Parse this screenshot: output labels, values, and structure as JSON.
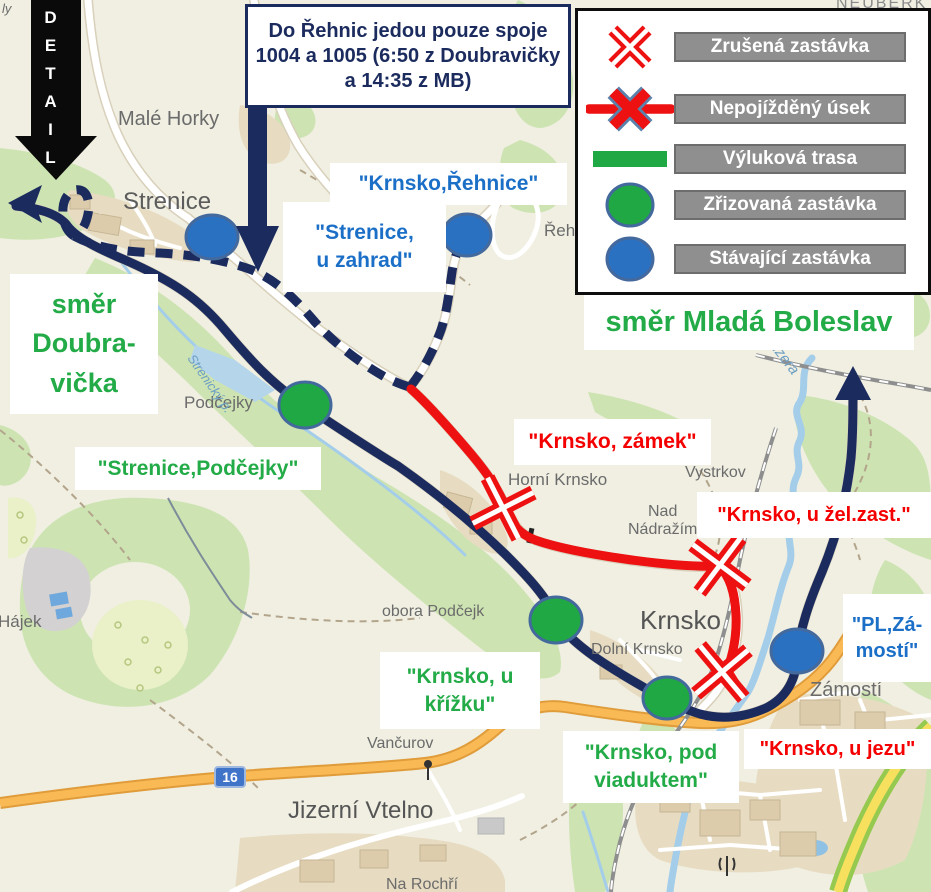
{
  "title": "Výluková mapa Krnsko",
  "info_box": {
    "text": "Do Řehnic jedou pouze spoje 1004 a 1005 (6:50 z Doubravičky a 14:35 z MB)"
  },
  "detail_arrow": {
    "label": "DETAIL"
  },
  "legend": {
    "items": [
      {
        "icon": "cancelled-stop-icon",
        "label": "Zrušená zastávka"
      },
      {
        "icon": "closed-section-icon",
        "label": "Nepojížděný úsek"
      },
      {
        "icon": "detour-route-icon",
        "label": "Výluková trasa"
      },
      {
        "icon": "new-stop-icon",
        "label": "Zřizovaná zastávka"
      },
      {
        "icon": "existing-stop-icon",
        "label": "Stávající zastávka"
      }
    ]
  },
  "directions": {
    "doubravicka": "směr\nDoubra-\nvička",
    "mlada_boleslav": "směr Mladá Boleslav"
  },
  "stops": [
    {
      "id": "krnsko-rehnice",
      "type": "existing",
      "text": "\"Krnsko,Řehnice\""
    },
    {
      "id": "strenice-u-zahrad",
      "type": "existing",
      "text": "\"Strenice,\nu zahrad\""
    },
    {
      "id": "strenice-podcejky",
      "type": "new",
      "text": "\"Strenice,Podčejky\""
    },
    {
      "id": "krnsko-zamek",
      "type": "cancelled",
      "text": "\"Krnsko, zámek\""
    },
    {
      "id": "krnsko-u-zel-zast",
      "type": "cancelled",
      "text": "\"Krnsko, u žel.zast.\""
    },
    {
      "id": "pl-zamosti",
      "type": "existing",
      "text": "\"PL,Zá-\nmostí\""
    },
    {
      "id": "krnsko-u-krizku",
      "type": "new",
      "text": "\"Krnsko, u\nkřížku\""
    },
    {
      "id": "krnsko-pod-viaduktem",
      "type": "new",
      "text": "\"Krnsko, pod\nviaduktem\""
    },
    {
      "id": "krnsko-u-jezu",
      "type": "cancelled",
      "text": "\"Krnsko, u jezu\""
    }
  ],
  "map_labels": {
    "neuberk": "NEUBERK",
    "male_horky": "Malé Horky",
    "strenice": "Strenice",
    "podcejky": "Podčejky",
    "hajek": "Hájek",
    "obora_podcejk": "obora Podčejk",
    "horni_krnsko": "Horní Krnsko",
    "vystrkov": "Vystrkov",
    "nad_nadrazim": "Nad\nNádražím",
    "krnsko": "Krnsko",
    "dolni_krnsko": "Dolní Krnsko",
    "zamosti": "Zámostí",
    "vancurov": "Vančurov",
    "jizerni_vtelno": "Jizerní Vtelno",
    "rehnice_partial": "Řeh",
    "na_roch": "Na Rochří",
    "ly_partial": "ly",
    "strenicky_p": "Strenický p.",
    "jizera": "Jizera"
  },
  "road_shield": "16",
  "colors": {
    "route_navy": "#1b2b5e",
    "route_red": "#ee1111",
    "detour_green": "#1fa844",
    "existing_blue": "#2b71c2",
    "label_blue": "#1b6fc7",
    "label_green": "#22ab47",
    "label_red": "#f50000",
    "legend_chip_gray": "#8f8f8f"
  }
}
